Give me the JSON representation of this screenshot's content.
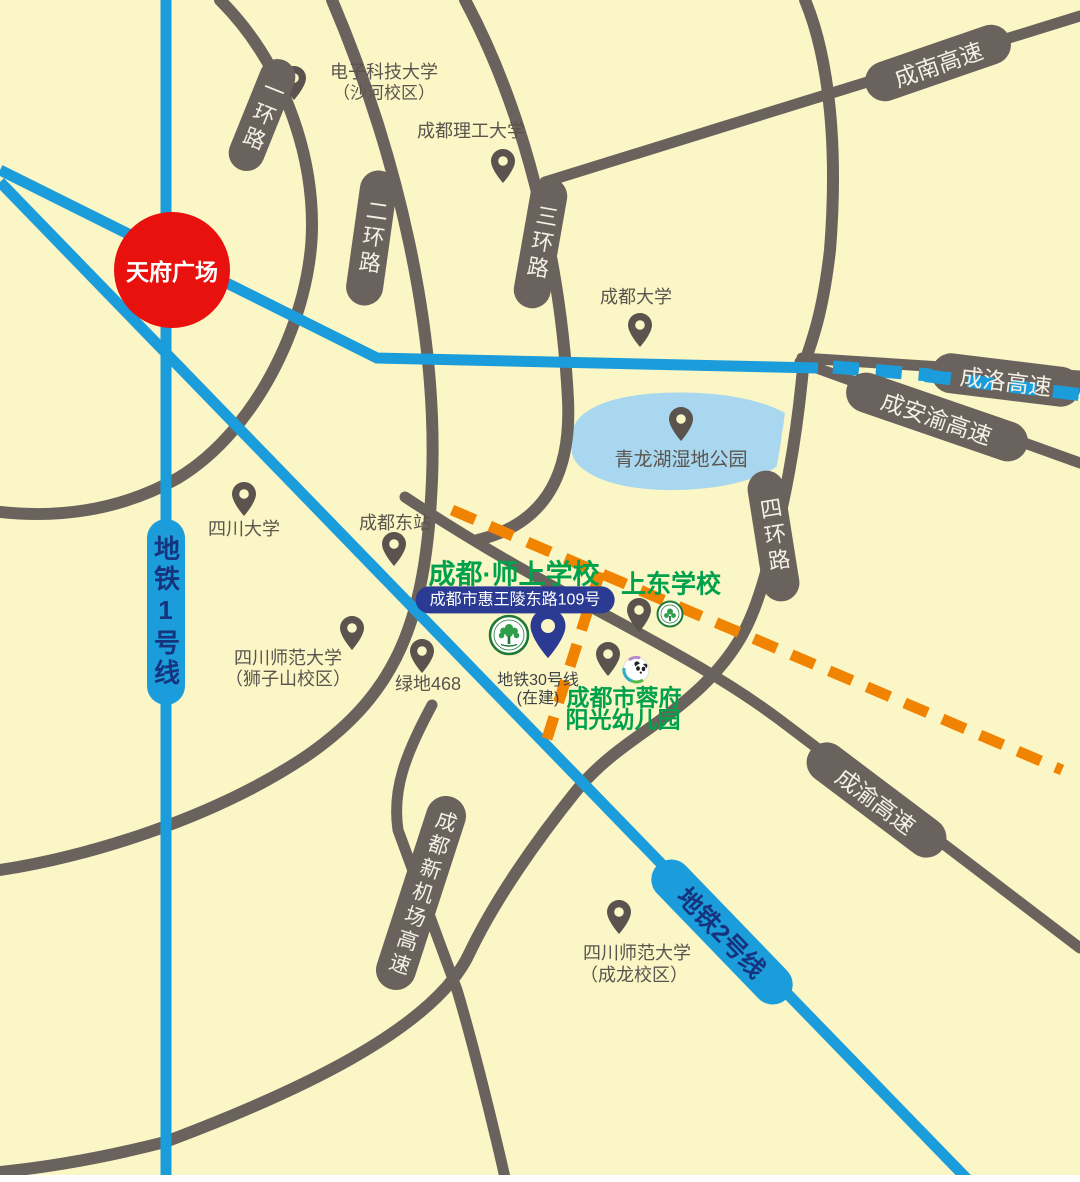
{
  "colors": {
    "bg": "#FAF6C5",
    "road": "#6A635D",
    "pin": "#5B544E",
    "metro": "#1B9DDB",
    "lake": "#A9D7EF",
    "red": "#E8110D",
    "green": "#00A14D",
    "navy": "#2B3A92",
    "orange": "#F08300",
    "label": "#5B544E",
    "pilltext": "#F4F0E6",
    "metrotext": "#16337E"
  },
  "plaza": {
    "label": "天府广场"
  },
  "lake": {
    "label": "青龙湖湿地公园"
  },
  "ring_roads": [
    {
      "label": "一环路"
    },
    {
      "label": "二环路"
    },
    {
      "label": "三环路"
    },
    {
      "label": "四环路"
    }
  ],
  "expressways": [
    {
      "label": "成南高速"
    },
    {
      "label": "成洛高速"
    },
    {
      "label": "成安渝高速"
    },
    {
      "label": "成渝高速"
    },
    {
      "label": "成都新机场高速"
    }
  ],
  "metro": {
    "line1": {
      "label": "地铁1号线"
    },
    "line2": {
      "label": "地铁2号线"
    },
    "line30": {
      "label": "地铁30号线",
      "status": "(在建)"
    }
  },
  "pois": [
    {
      "name": "电子科技大学",
      "branch": "（沙河校区）"
    },
    {
      "name": "成都理工大学"
    },
    {
      "name": "成都大学"
    },
    {
      "name": "四川大学"
    },
    {
      "name": "成都东站"
    },
    {
      "name": "四川师范大学",
      "branch": "（狮子山校区）"
    },
    {
      "name": "绿地468"
    },
    {
      "name": "四川师范大学",
      "branch": "（成龙校区）"
    }
  ],
  "featured_school": {
    "name": "成都·师上学校",
    "address": "成都市惠王陵东路109号"
  },
  "nearby_schools": {
    "shangdong": {
      "name": "上东学校"
    },
    "kindergarten": {
      "name_line1": "成都市蓉府",
      "name_line2": "阳光幼儿园"
    }
  }
}
